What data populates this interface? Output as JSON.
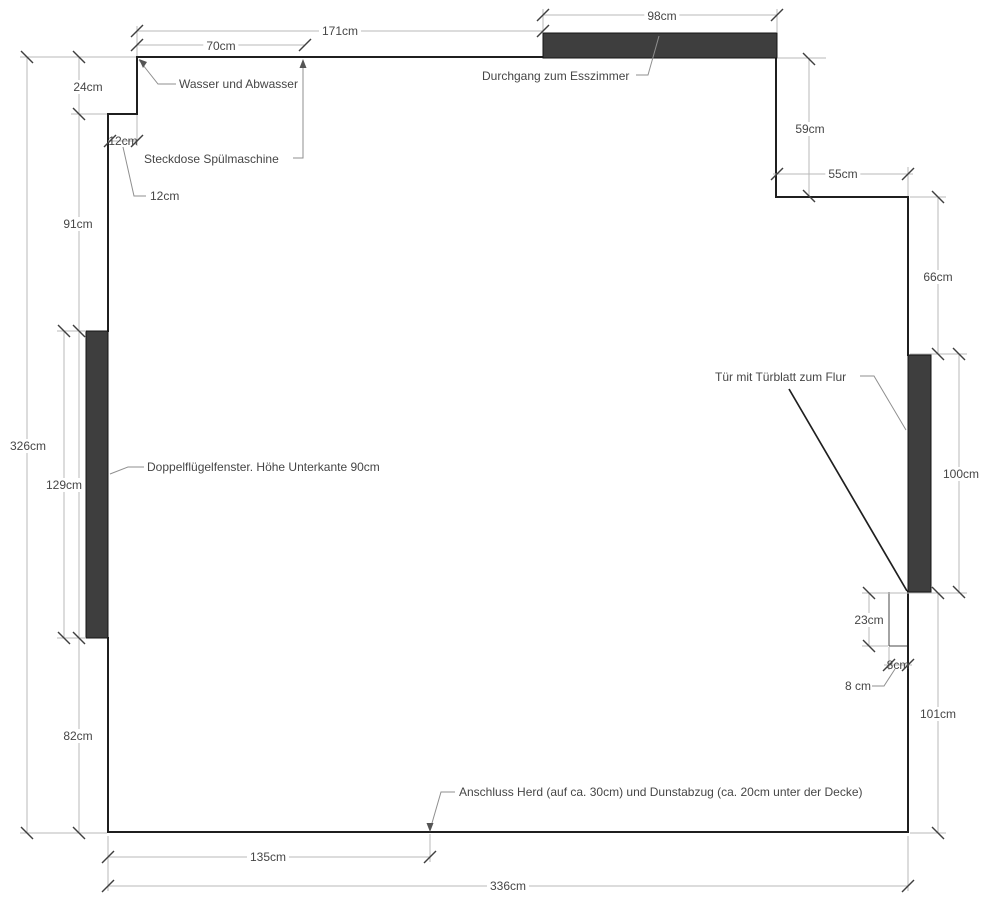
{
  "drawing_title": "Kitchen floor plan with dimensions",
  "dims": {
    "w70": "70cm",
    "w171": "171cm",
    "w98": "98cm",
    "h24": "24cm",
    "w12": "12cm",
    "w12_callout": "12cm",
    "h91": "91cm",
    "h326": "326cm",
    "h129": "129cm",
    "h82": "82cm",
    "h59": "59cm",
    "w55": "55cm",
    "h66": "66cm",
    "h100": "100cm",
    "h23": "23cm",
    "w8": "8cm",
    "w8_callout": "8 cm",
    "h101": "101cm",
    "w135": "135cm",
    "w336": "336cm"
  },
  "annotations": {
    "water": "Wasser und Abwasser",
    "dishwasher_socket": "Steckdose Spülmaschine",
    "passage": "Durchgang zum Esszimmer",
    "door": "Tür mit Türblatt zum Flur",
    "window": "Doppelflügelfenster. Höhe Unterkante 90cm",
    "stove": "Anschluss Herd (auf ca. 30cm) und Dunstabzug (ca. 20cm unter der Decke)"
  },
  "colors": {
    "wall": "#1f1f1f",
    "opening_fill": "#3e3e3e",
    "dimension_line": "#b9b9b9",
    "tick": "#3f3f3f",
    "leader": "#8f8f8f",
    "text": "#464646",
    "background": "#ffffff"
  }
}
